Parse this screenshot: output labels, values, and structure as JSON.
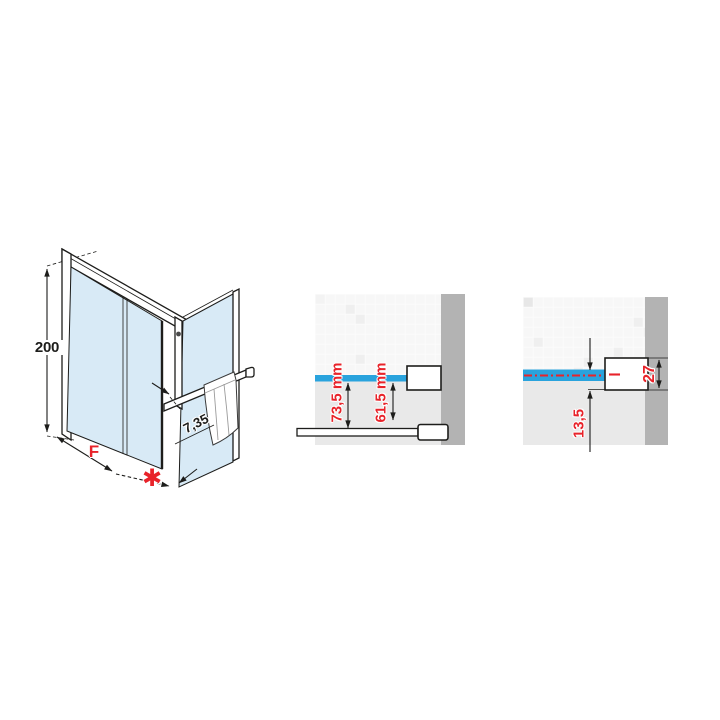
{
  "left_diagram": {
    "height_label": "200",
    "width_label": "F",
    "gap_label": "✱",
    "depth_label": "7,35"
  },
  "middle_detail": {
    "outer_dim_label": "73,5 mm",
    "inner_dim_label": "61,5 mm"
  },
  "right_detail": {
    "offset_dim_label": "13,5",
    "profile_dim_label": "27"
  },
  "colors": {
    "accent_red": "#e8232a",
    "glass_section_blue": "#29a3dd",
    "glass_fill_blue": "#d8eaf6",
    "wall_gray": "#b3b3b3",
    "line_black": "#1d1d1b"
  }
}
